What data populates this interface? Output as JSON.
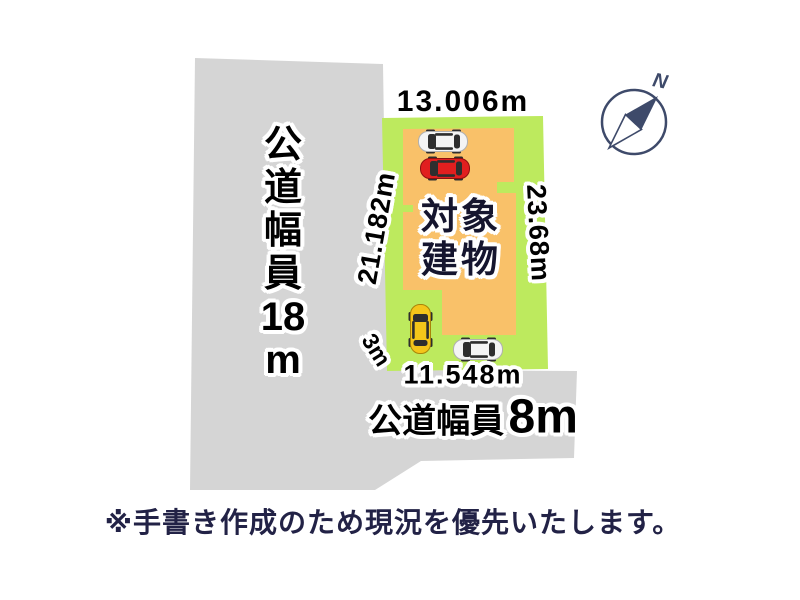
{
  "colors": {
    "road": "#d5d5d5",
    "plot": "#bdea5e",
    "building": "#f9c169",
    "ink": "#000000",
    "navy": "#222246",
    "compass": "#3e4a6a",
    "car_red": "#e11f1f",
    "car_yellow": "#f4c51a",
    "car_white": "#f4f4f4",
    "car_window": "#2e2e2e"
  },
  "plan": {
    "dim_top": "13.006m",
    "dim_left": "21.182m",
    "dim_right": "23.68m",
    "dim_bottom": "11.548m",
    "dim_side": "3m",
    "building_label_line1": "対象",
    "building_label_line2": "建物",
    "road_left_label_chars": [
      "公",
      "道",
      "幅",
      "員",
      "18",
      "m"
    ],
    "road_bottom_label_prefix": "公道幅員",
    "road_bottom_label_value": "8m",
    "compass_north": "N"
  },
  "footer": {
    "disclaimer": "※手書き作成のため現況を優先いたします。"
  }
}
